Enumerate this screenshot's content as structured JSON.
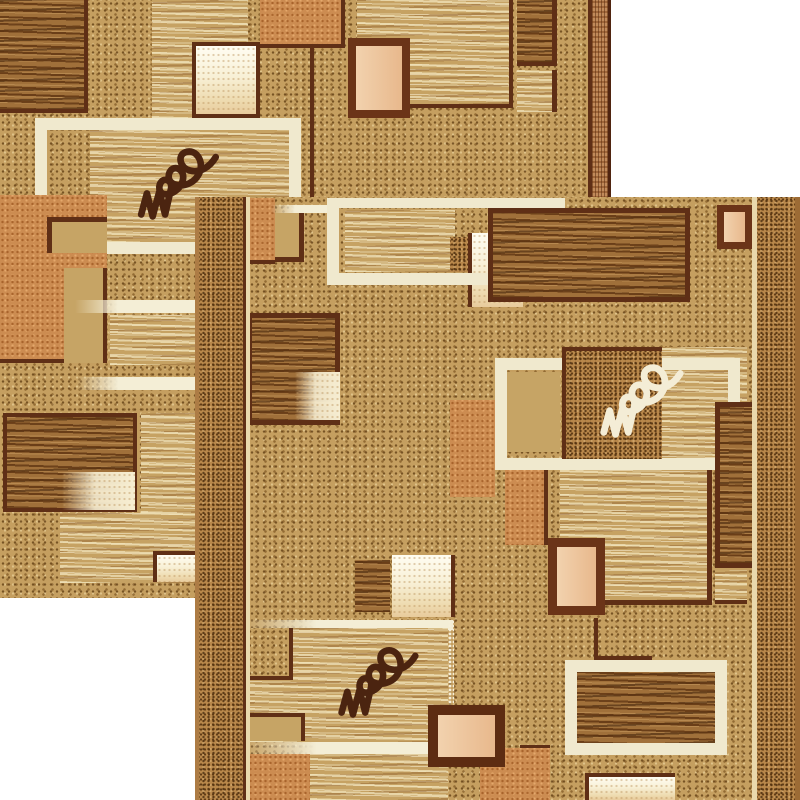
{
  "scene": {
    "description": "Product photo: two overlapping beige-brown runner rugs with a geometric patchwork pattern of speckled, wavy-textured and solid squares, cream window frames and scribble signature motifs, on a white background",
    "background": "#ffffff"
  },
  "palette": {
    "field_tan": "#c59f60",
    "speckle_dark": "#7b5224",
    "dense_band": "#b8874a",
    "orange": "#cc8c51",
    "wavy_dark": "#a0703a",
    "wavy_light": "#c6a263",
    "cream": "#f2ecd2",
    "window_cream": "#f0e9ce",
    "peach": "#ecbf97",
    "frame_brown": "#5f2f16",
    "signature_dark": "#4b2410",
    "signature_cream": "#f4edd6"
  },
  "rugs": [
    {
      "id": "rug-back",
      "x": 0,
      "y": 0,
      "w": 611,
      "h": 598,
      "z": 1,
      "base": "field",
      "tiles": [
        {
          "name": "wavy-panel-dark",
          "tex": "wavyd",
          "x": 0,
          "y": 0,
          "w": 88,
          "h": 113,
          "bd": {
            "r": 4,
            "b": 4
          }
        },
        {
          "name": "wavy-panel-light",
          "tex": "wavyl",
          "x": 152,
          "y": 0,
          "w": 96,
          "h": 118
        },
        {
          "name": "cream-gradient-square",
          "tex": "creamgrad",
          "x": 192,
          "y": 42,
          "w": 68,
          "h": 76,
          "bd": {
            "t": 4,
            "r": 4,
            "b": 4,
            "l": 4
          }
        },
        {
          "name": "accent-square-orange",
          "tex": "orange",
          "x": 260,
          "y": 0,
          "w": 85,
          "h": 48,
          "bd": {
            "r": 4,
            "b": 4
          }
        },
        {
          "name": "wavy-panel-light-large",
          "tex": "wavyl",
          "x": 357,
          "y": 0,
          "w": 156,
          "h": 108,
          "bd": {
            "r": 4,
            "b": 4
          }
        },
        {
          "name": "wavy-panel-dark-small",
          "tex": "wavyd",
          "x": 517,
          "y": 0,
          "w": 40,
          "h": 66,
          "bd": {
            "r": 5,
            "b": 4
          }
        },
        {
          "name": "wavy-panel-light-small",
          "tex": "wavyl",
          "x": 517,
          "y": 70,
          "w": 40,
          "h": 42,
          "bd": {
            "r": 5
          }
        },
        {
          "name": "framed-peach-rect",
          "tex": "peach",
          "x": 348,
          "y": 38,
          "w": 62,
          "h": 80,
          "bd": {
            "t": 8,
            "r": 8,
            "b": 8,
            "l": 8,
            "c": "#6b3418"
          }
        },
        {
          "name": "divider-line-vertical",
          "tex": "brown",
          "x": 310,
          "y": 48,
          "w": 4,
          "h": 150
        },
        {
          "name": "wavy-signature-panel",
          "tex": "wavyl",
          "x": 90,
          "y": 130,
          "w": 208,
          "h": 112
        },
        {
          "name": "cream-window-frame",
          "tex": "none",
          "x": 35,
          "y": 118,
          "w": 266,
          "h": 136,
          "bd": {
            "t": 12,
            "r": 12,
            "b": 12,
            "l": 12,
            "c": "#f0e9ce"
          }
        },
        {
          "name": "signature-scribble-dark",
          "tex": "sig",
          "x": 125,
          "y": 138,
          "w": 105,
          "h": 86,
          "color": "#4b2410"
        },
        {
          "name": "accent-rect-orange-large",
          "tex": "orange",
          "x": 0,
          "y": 195,
          "w": 107,
          "h": 168,
          "bd": {
            "b": 4
          }
        },
        {
          "name": "framed-tan-rect-cut",
          "tex": "tan",
          "x": 47,
          "y": 217,
          "w": 60,
          "h": 36,
          "bd": {
            "t": 5,
            "l": 5
          }
        },
        {
          "name": "tan-block",
          "tex": "tan",
          "x": 64,
          "y": 268,
          "w": 43,
          "h": 95,
          "bd": {
            "r": 4
          }
        },
        {
          "name": "cream-stripe",
          "tex": "creamstripe",
          "x": 75,
          "y": 300,
          "w": 122,
          "h": 13
        },
        {
          "name": "wavy-patch-light",
          "tex": "wavyl",
          "x": 110,
          "y": 315,
          "w": 88,
          "h": 50
        },
        {
          "name": "cream-stripe",
          "tex": "creamstripe",
          "x": 76,
          "y": 377,
          "w": 121,
          "h": 13
        },
        {
          "name": "framed-wavy-rect",
          "tex": "wavyd",
          "x": 3,
          "y": 413,
          "w": 134,
          "h": 99,
          "bd": {
            "t": 4,
            "r": 4,
            "b": 4,
            "l": 4
          }
        },
        {
          "name": "cream-gradient-block",
          "tex": "creamgradl",
          "x": 62,
          "y": 472,
          "w": 73,
          "h": 38
        },
        {
          "name": "wavy-patch-light",
          "tex": "wavyl",
          "x": 141,
          "y": 413,
          "w": 57,
          "h": 100
        },
        {
          "name": "wavy-patch-light",
          "tex": "wavyl",
          "x": 60,
          "y": 513,
          "w": 140,
          "h": 70
        },
        {
          "name": "cream-block",
          "tex": "creamgrad",
          "x": 153,
          "y": 551,
          "w": 47,
          "h": 31,
          "bd": {
            "t": 4,
            "l": 4
          }
        },
        {
          "name": "border-line",
          "tex": "brown",
          "x": 588,
          "y": 0,
          "w": 4,
          "h": 598
        },
        {
          "name": "border-woven-band",
          "tex": "woven",
          "x": 592,
          "y": 0,
          "w": 16,
          "h": 598
        },
        {
          "name": "rug-edge-stripe",
          "tex": "edgedark",
          "x": 608,
          "y": 0,
          "w": 3,
          "h": 598
        }
      ]
    },
    {
      "id": "rug-front",
      "x": 195,
      "y": 197,
      "w": 605,
      "h": 603,
      "z": 2,
      "base": "field",
      "tiles": [
        {
          "name": "accent-band-orange",
          "tex": "orange",
          "x": 55,
          "y": 1,
          "w": 25,
          "h": 66,
          "bd": {
            "b": 4
          }
        },
        {
          "name": "tan-block",
          "tex": "tan",
          "x": 80,
          "y": 16,
          "w": 29,
          "h": 49,
          "bd": {
            "r": 5,
            "b": 5
          }
        },
        {
          "name": "cream-stripe",
          "tex": "creamstripe",
          "x": 76,
          "y": 8,
          "w": 68,
          "h": 8
        },
        {
          "name": "wavy-panel-light",
          "tex": "wavyl",
          "x": 150,
          "y": 13,
          "w": 110,
          "h": 62
        },
        {
          "name": "dense-speckle-square",
          "tex": "dense",
          "x": 255,
          "y": 40,
          "w": 73,
          "h": 35
        },
        {
          "name": "cream-gradient-square",
          "tex": "creamgrad",
          "x": 273,
          "y": 36,
          "w": 55,
          "h": 74,
          "bd": {
            "l": 4
          }
        },
        {
          "name": "cream-window-frame",
          "tex": "none",
          "x": 132,
          "y": 1,
          "w": 238,
          "h": 87,
          "bd": {
            "t": 10,
            "r": 12,
            "b": 12,
            "l": 12,
            "c": "#f0e9ce"
          }
        },
        {
          "name": "framed-wavy-rect-large",
          "tex": "wavyd",
          "x": 293,
          "y": 11,
          "w": 202,
          "h": 94,
          "bd": {
            "t": 5,
            "r": 5,
            "b": 5,
            "l": 5
          }
        },
        {
          "name": "framed-peach-rect-small",
          "tex": "peach",
          "x": 522,
          "y": 8,
          "w": 35,
          "h": 44,
          "bd": {
            "t": 7,
            "r": 7,
            "b": 7,
            "l": 7,
            "c": "#6b3418"
          }
        },
        {
          "name": "framed-wavy-rect",
          "tex": "wavyd",
          "x": 52,
          "y": 116,
          "w": 93,
          "h": 112,
          "bd": {
            "t": 5,
            "r": 5,
            "b": 5,
            "l": 5
          }
        },
        {
          "name": "cream-gradient-block",
          "tex": "creamgradl",
          "x": 100,
          "y": 175,
          "w": 45,
          "h": 48
        },
        {
          "name": "tan-block",
          "tex": "tan",
          "x": 310,
          "y": 175,
          "w": 55,
          "h": 80
        },
        {
          "name": "wavy-panel-light",
          "tex": "wavyl",
          "x": 467,
          "y": 150,
          "w": 85,
          "h": 115
        },
        {
          "name": "cream-window-frame",
          "tex": "none",
          "x": 300,
          "y": 161,
          "w": 245,
          "h": 112,
          "bd": {
            "t": 12,
            "r": 12,
            "b": 12,
            "l": 12,
            "c": "#f0e9ce"
          }
        },
        {
          "name": "signature-square-dense",
          "tex": "dense",
          "x": 367,
          "y": 150,
          "w": 100,
          "h": 112,
          "bd": {
            "t": 4,
            "l": 4
          }
        },
        {
          "name": "signature-scribble-cream",
          "tex": "sig",
          "x": 397,
          "y": 150,
          "w": 98,
          "h": 102,
          "color": "#f4edd6"
        },
        {
          "name": "accent-band-orange",
          "tex": "orange",
          "x": 255,
          "y": 203,
          "w": 45,
          "h": 97
        },
        {
          "name": "wavy-panel-dark-tall",
          "tex": "wavyd",
          "x": 520,
          "y": 205,
          "w": 37,
          "h": 166,
          "bd": {
            "t": 5,
            "l": 5,
            "b": 5
          }
        },
        {
          "name": "accent-block-orange",
          "tex": "orange",
          "x": 310,
          "y": 273,
          "w": 43,
          "h": 75,
          "bd": {
            "r": 4
          }
        },
        {
          "name": "wavy-panel-light-large",
          "tex": "wavyl",
          "x": 365,
          "y": 273,
          "w": 152,
          "h": 135,
          "bd": {
            "r": 5,
            "b": 5
          }
        },
        {
          "name": "wavy-patch-light",
          "tex": "wavyl",
          "x": 520,
          "y": 373,
          "w": 32,
          "h": 34,
          "bd": {
            "b": 4
          }
        },
        {
          "name": "framed-peach-rect",
          "tex": "peach",
          "x": 353,
          "y": 341,
          "w": 57,
          "h": 77,
          "bd": {
            "t": 9,
            "r": 9,
            "b": 9,
            "l": 9,
            "c": "#6b3418"
          }
        },
        {
          "name": "divider-line-vertical",
          "tex": "brown",
          "x": 399,
          "y": 421,
          "w": 4,
          "h": 42
        },
        {
          "name": "divider-line-horizontal",
          "tex": "brown",
          "x": 403,
          "y": 459,
          "w": 54,
          "h": 4
        },
        {
          "name": "wavy-panel-dark",
          "tex": "wavyd",
          "x": 382,
          "y": 475,
          "w": 138,
          "h": 71
        },
        {
          "name": "cream-window-frame",
          "tex": "none",
          "x": 370,
          "y": 463,
          "w": 162,
          "h": 95,
          "bd": {
            "t": 12,
            "r": 12,
            "b": 12,
            "l": 12,
            "c": "#f0e9ce"
          }
        },
        {
          "name": "cream-gradient-block",
          "tex": "creamgrad",
          "x": 390,
          "y": 576,
          "w": 90,
          "h": 27,
          "bd": {
            "t": 4,
            "l": 4
          }
        },
        {
          "name": "accent-block-orange",
          "tex": "orange",
          "x": 325,
          "y": 548,
          "w": 30,
          "h": 55,
          "bd": {
            "t": 4
          }
        },
        {
          "name": "wavy-panel-dark-small",
          "tex": "wavyd",
          "x": 160,
          "y": 363,
          "w": 35,
          "h": 52
        },
        {
          "name": "cream-gradient-square",
          "tex": "creamgrad",
          "x": 197,
          "y": 358,
          "w": 63,
          "h": 62,
          "bd": {
            "r": 4
          }
        },
        {
          "name": "cream-stripe",
          "tex": "creamstripe",
          "x": 48,
          "y": 423,
          "w": 210,
          "h": 10
        },
        {
          "name": "wavy-signature-panel",
          "tex": "wavyl",
          "x": 52,
          "y": 431,
          "w": 201,
          "h": 114
        },
        {
          "name": "speckle-square",
          "tex": "field",
          "x": 52,
          "y": 431,
          "w": 46,
          "h": 52,
          "bd": {
            "r": 4,
            "b": 4
          }
        },
        {
          "name": "signature-scribble-dark",
          "tex": "sig",
          "x": 135,
          "y": 440,
          "w": 95,
          "h": 85,
          "color": "#4b2410"
        },
        {
          "name": "cream-dot-stripe-vertical",
          "tex": "creamdots",
          "x": 253,
          "y": 423,
          "w": 6,
          "h": 129
        },
        {
          "name": "cream-stripe",
          "tex": "creamstripe",
          "x": 48,
          "y": 545,
          "w": 210,
          "h": 12
        },
        {
          "name": "tan-block",
          "tex": "tan",
          "x": 52,
          "y": 516,
          "w": 58,
          "h": 28,
          "bd": {
            "t": 4,
            "r": 4
          }
        },
        {
          "name": "accent-block-orange",
          "tex": "orange",
          "x": 48,
          "y": 557,
          "w": 67,
          "h": 46
        },
        {
          "name": "wavy-patch-light",
          "tex": "wavyl",
          "x": 115,
          "y": 557,
          "w": 138,
          "h": 46
        },
        {
          "name": "accent-block-orange",
          "tex": "orange",
          "x": 285,
          "y": 551,
          "w": 70,
          "h": 52
        },
        {
          "name": "framed-peach-rect-large",
          "tex": "peach",
          "x": 233,
          "y": 508,
          "w": 77,
          "h": 62,
          "bd": {
            "t": 10,
            "r": 10,
            "b": 10,
            "l": 10,
            "c": "#5d2c12"
          }
        },
        {
          "name": "rug-edge-stripe",
          "tex": "edgetan",
          "x": 0,
          "y": 0,
          "w": 4,
          "h": 603
        },
        {
          "name": "border-speckle-band",
          "tex": "dense",
          "x": 4,
          "y": 0,
          "w": 44,
          "h": 603
        },
        {
          "name": "border-line",
          "tex": "brown",
          "x": 48,
          "y": 0,
          "w": 3,
          "h": 603
        },
        {
          "name": "border-cream-stripe",
          "tex": "creamsolid",
          "x": 51,
          "y": 0,
          "w": 4,
          "h": 603
        },
        {
          "name": "border-cream-stripe",
          "tex": "creamsolid",
          "x": 557,
          "y": 0,
          "w": 5,
          "h": 603
        },
        {
          "name": "border-speckle-band",
          "tex": "dense",
          "x": 562,
          "y": 0,
          "w": 38,
          "h": 603
        },
        {
          "name": "rug-edge-stripe",
          "tex": "edgeright",
          "x": 600,
          "y": 0,
          "w": 5,
          "h": 603
        }
      ]
    }
  ]
}
